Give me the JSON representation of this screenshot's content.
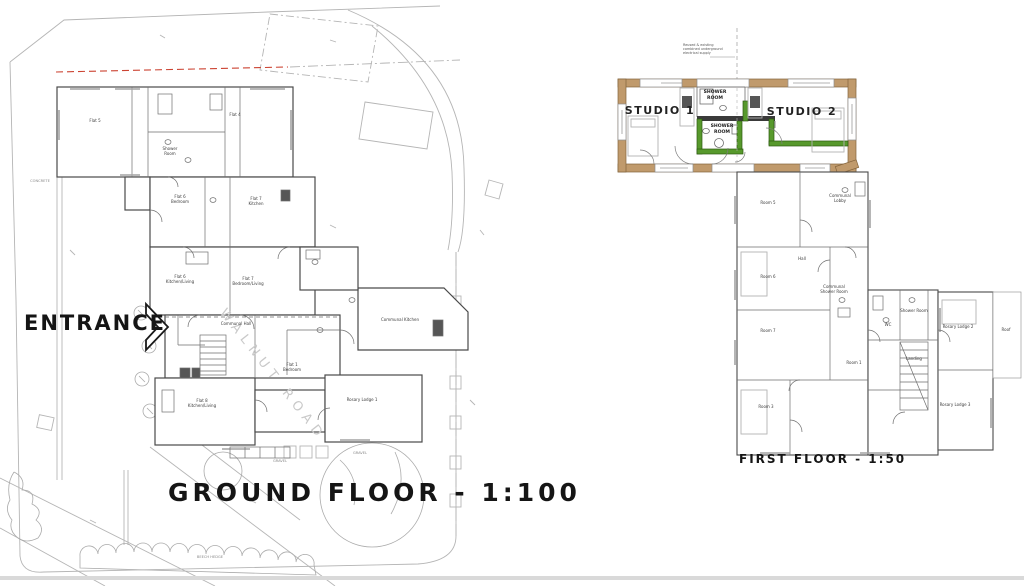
{
  "titles": {
    "ground_floor": "GROUND FLOOR - 1:100",
    "first_floor": "FIRST FLOOR - 1:50",
    "entrance": "ENTRANCE"
  },
  "studios": {
    "studio1": "STUDIO 1",
    "studio2": "STUDIO 2",
    "shower_top": "SHOWER\nROOM",
    "shower_mid": "SHOWER\nROOM",
    "annotation": "Reused & existing\ncombined underground\nelectrical supply"
  },
  "road_watermark": "WALNUT ROAD",
  "gf_labels": [
    "Flat 5",
    "Flat 4",
    "Shower\nRoom",
    "Flat 6\nBedroom",
    "Flat 7\nKitchen",
    "Flat 6\nKitchen/Living",
    "Flat 7\nBedroom/Living",
    "Communal Hall",
    "Flat 8\nKitchen/Living",
    "Rosary Lodge 1",
    "Communal Kitchen",
    "GRAVEL",
    "GRAVEL",
    "BEECH HEDGE",
    "CONCRETE",
    "Flat 1\nBedroom"
  ],
  "ff_labels": [
    "Room 5",
    "Communal\nLobby",
    "Hall",
    "Room 6",
    "Communal\nShower Room",
    "Room 7",
    "Room 3",
    "Room 1",
    "Shower Room",
    "WC",
    "Landing",
    "Rosary Lodge 2",
    "Rosary Lodge 3",
    "Roof"
  ],
  "colors": {
    "wall_tan": "#c09a6c",
    "wall_tan_edge": "#84halfway",
    "highlight_green": "#57992c",
    "green_edge": "#2d5a10",
    "boundary_red_dashed": "#cc4433",
    "plan_line": "#4a4a4a",
    "site_line": "#b5b5b5"
  }
}
